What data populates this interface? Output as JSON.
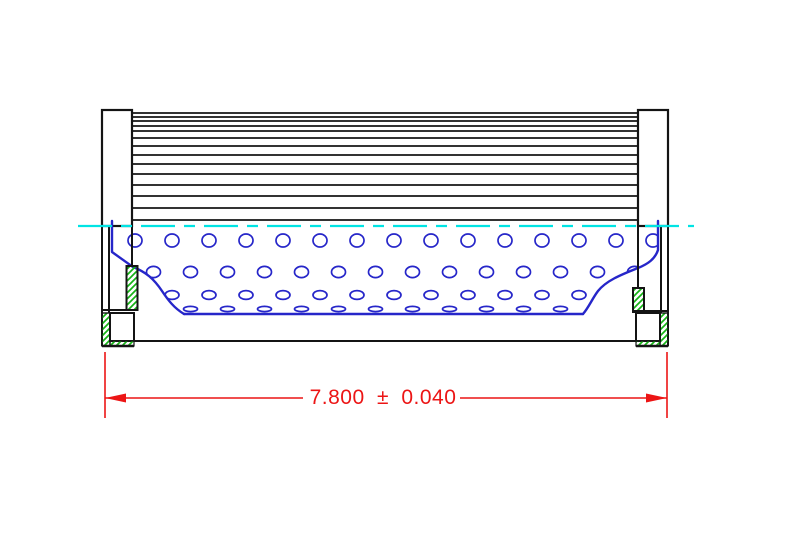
{
  "app": {
    "type": "cad-technical-drawing",
    "subject": "filter-element-side-section-view"
  },
  "dimension": {
    "label": "7.800 ± 0.040",
    "nominal": "7.800",
    "plus_minus": "±",
    "tolerance": "0.040"
  },
  "colors": {
    "background": "#ffffff",
    "outline": "#141414",
    "media_blue": "#2626c9",
    "centerline_cyan": "#00e4e4",
    "dimension_red": "#ec1515",
    "hatch_green": "#16b416",
    "fill_white": "#ffffff"
  },
  "geometry": {
    "canvas": {
      "w": 789,
      "h": 546
    },
    "left_cap": {
      "x": 102,
      "y": 110,
      "w": 30,
      "h": 116
    },
    "right_cap": {
      "x": 638,
      "y": 110,
      "w": 30,
      "h": 116
    },
    "pleats": {
      "x1": 132,
      "x2": 638,
      "ys": [
        113,
        117,
        121,
        126,
        131,
        138,
        146,
        155,
        164,
        174,
        185,
        196,
        208,
        220
      ]
    },
    "centerline": {
      "x1": 78,
      "x2": 694,
      "y": 226,
      "dash": "34 9 11 9"
    },
    "holes": {
      "rx": 7,
      "step": 37,
      "rows": [
        {
          "y": 240.5,
          "ry": 6.5,
          "x0": 135,
          "count": 15
        },
        {
          "y": 272,
          "ry": 5.6,
          "x0": 153.5,
          "count": 14
        },
        {
          "y": 295,
          "ry": 4.4,
          "x0": 172,
          "count": 13
        },
        {
          "y": 309,
          "ry": 2.6,
          "x0": 190.5,
          "count": 12
        }
      ]
    },
    "core_clip": "M112,220 H658 V250 C655,259 648,264 638,268 C620,275 606,281 598,291 C592,299 589,307 583,314 L184,314 C174,308 168,300 162,291 C154,279 146,272 133,267 L112,252 Z",
    "profile_paths": [
      "M112,221 V252 L133,267 C146,272 154,279 162,291 C168,300 174,308 184,314",
      "M658,221 V250 C655,259 648,264 638,268 C620,275 606,281 598,291 C592,299 589,307 583,314",
      "M184,314 H583"
    ],
    "left_structure": {
      "wall_outer": {
        "x": 102,
        "y1": 226,
        "y2": 346
      },
      "wall_inner": {
        "x": 109,
        "y1": 226,
        "y2": 313
      },
      "inner_edge": {
        "x": 132,
        "y1": 226,
        "y2": 266
      },
      "seal_band": {
        "x": 126.5,
        "y": 266,
        "w": 11,
        "h": 44
      },
      "step_line": {
        "x1": 102,
        "x2": 137,
        "y": 310
      },
      "lower_box": {
        "x": 110,
        "y": 313,
        "w": 24,
        "h": 28
      },
      "hatch_side": {
        "x": 102,
        "y": 313,
        "w": 8,
        "h": 33
      },
      "hatch_bottom": {
        "x": 110,
        "y": 341,
        "w": 24,
        "h": 5
      },
      "base_line": {
        "x1": 102,
        "x2": 134,
        "y": 346
      }
    },
    "right_structure": {
      "wall_outer": {
        "x": 668,
        "y1": 226,
        "y2": 346
      },
      "wall_inner": {
        "x": 661,
        "y1": 226,
        "y2": 313
      },
      "inner_edge": {
        "x": 638,
        "y1": 226,
        "y2": 288
      },
      "seal_band": {
        "x": 633,
        "y": 288,
        "w": 11,
        "h": 24
      },
      "step_line": {
        "x1": 633,
        "x2": 668,
        "y": 311
      },
      "lower_box": {
        "x": 636,
        "y": 313,
        "w": 24,
        "h": 28
      },
      "hatch_side": {
        "x": 660,
        "y": 313,
        "w": 8,
        "h": 33
      },
      "hatch_bottom": {
        "x": 636,
        "y": 341,
        "w": 24,
        "h": 5
      },
      "base_line": {
        "x1": 636,
        "x2": 668,
        "y": 346
      }
    },
    "bottom_line": {
      "x1": 134,
      "x2": 636,
      "y": 341
    },
    "dim": {
      "ext_y1": 352,
      "ext_y2": 418,
      "x1": 105,
      "x2": 667,
      "line_y": 398,
      "gap_x1": 303,
      "gap_x2": 460,
      "arrow_len": 21,
      "arrow_half": 4.5,
      "text_x": 383,
      "text_y": 404,
      "font_size": 21
    }
  }
}
